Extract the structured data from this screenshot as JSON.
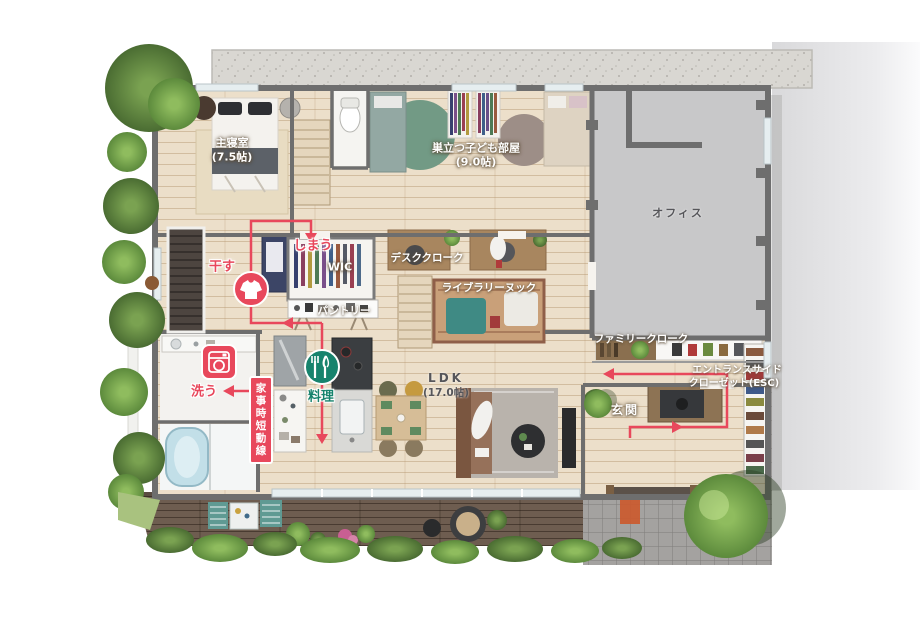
{
  "rooms": {
    "master_bedroom": {
      "label": "主寝室",
      "size": "(7.5帖)"
    },
    "kids_room": {
      "label": "巣立つ子ども部屋",
      "size": "(9.0帖)"
    },
    "office": {
      "label": "オフィス"
    },
    "desk_cloak": {
      "label": "デスククローク"
    },
    "library_nook": {
      "label": "ライブラリーヌック"
    },
    "wic": {
      "label": "WIC"
    },
    "pantry": {
      "label": "パントリー"
    },
    "ldk": {
      "label": "LDK",
      "size": "(17.0帖)"
    },
    "family_cloak": {
      "label": "ファミリークローク"
    },
    "entrance_side_closet": {
      "label_line1": "エントランスサイド",
      "label_line2": "クローゼット(ESC)"
    },
    "entrance": {
      "label": "玄関"
    }
  },
  "flow": {
    "shortcut_box": "家事時短動線",
    "dry": "干す",
    "store": "しまう",
    "wash": "洗う",
    "cook": "料理"
  },
  "icons": {
    "dry": "shirt-icon",
    "wash": "washing-machine-icon",
    "cook": "cutlery-icon",
    "approach": "up-arrow-icon"
  },
  "colors": {
    "flow_red": "#e8485c",
    "cook_green": "#17836d",
    "approach_orange": "#cb5a2e"
  }
}
